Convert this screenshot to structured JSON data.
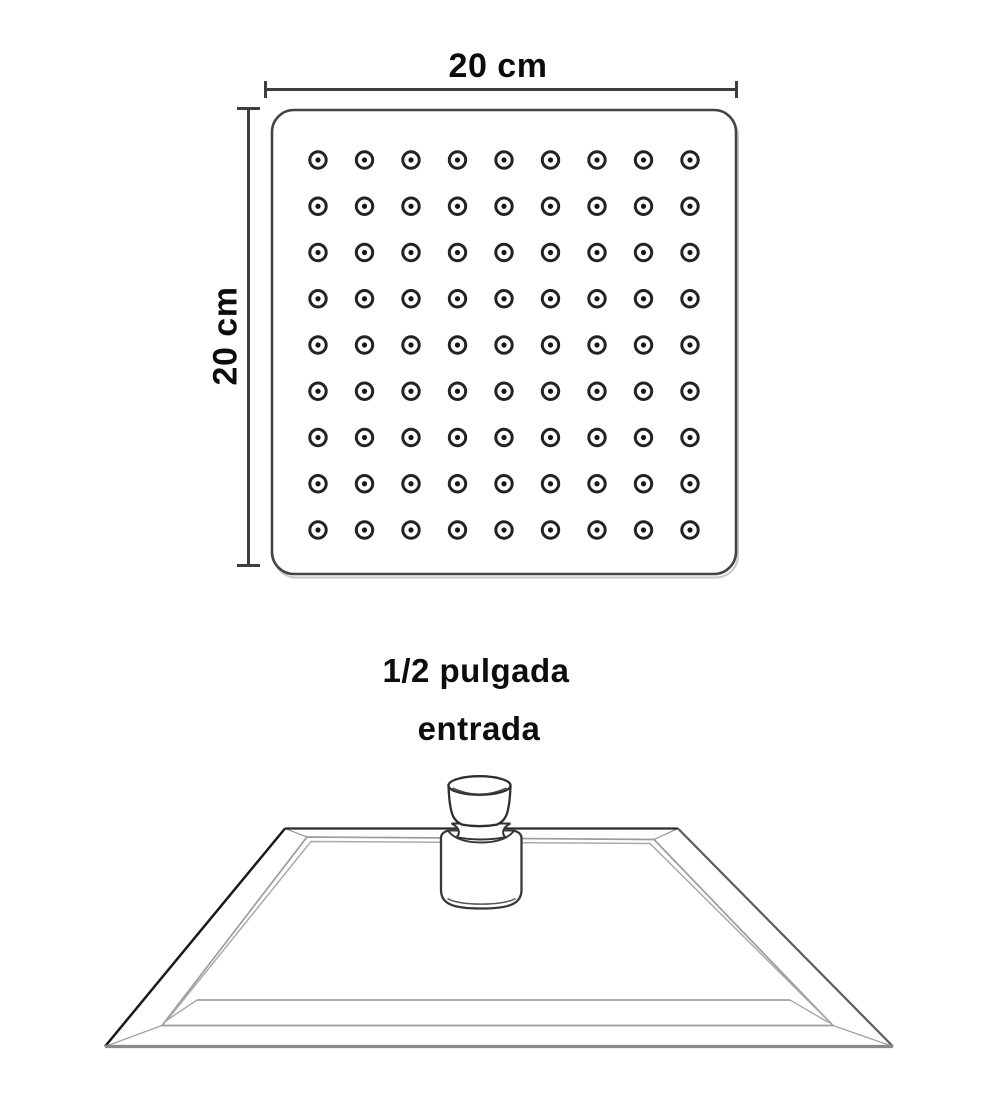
{
  "top_view": {
    "width_label": "20 cm",
    "height_label": "20 cm",
    "nozzle_rows": 9,
    "nozzle_cols": 9,
    "nozzle_count": 81
  },
  "inlet": {
    "line1": "1/2 pulgada",
    "line2": "entrada"
  },
  "colors": {
    "background": "#ffffff",
    "text": "#0d0d0d",
    "dimension_line": "#3e3e3e",
    "plate_outline": "#454545",
    "nozzle_ring": "#232323",
    "side_outline_dark": "#1a1a1a",
    "side_outline_light": "#9c9c9c",
    "connector_stroke": "#383838"
  }
}
